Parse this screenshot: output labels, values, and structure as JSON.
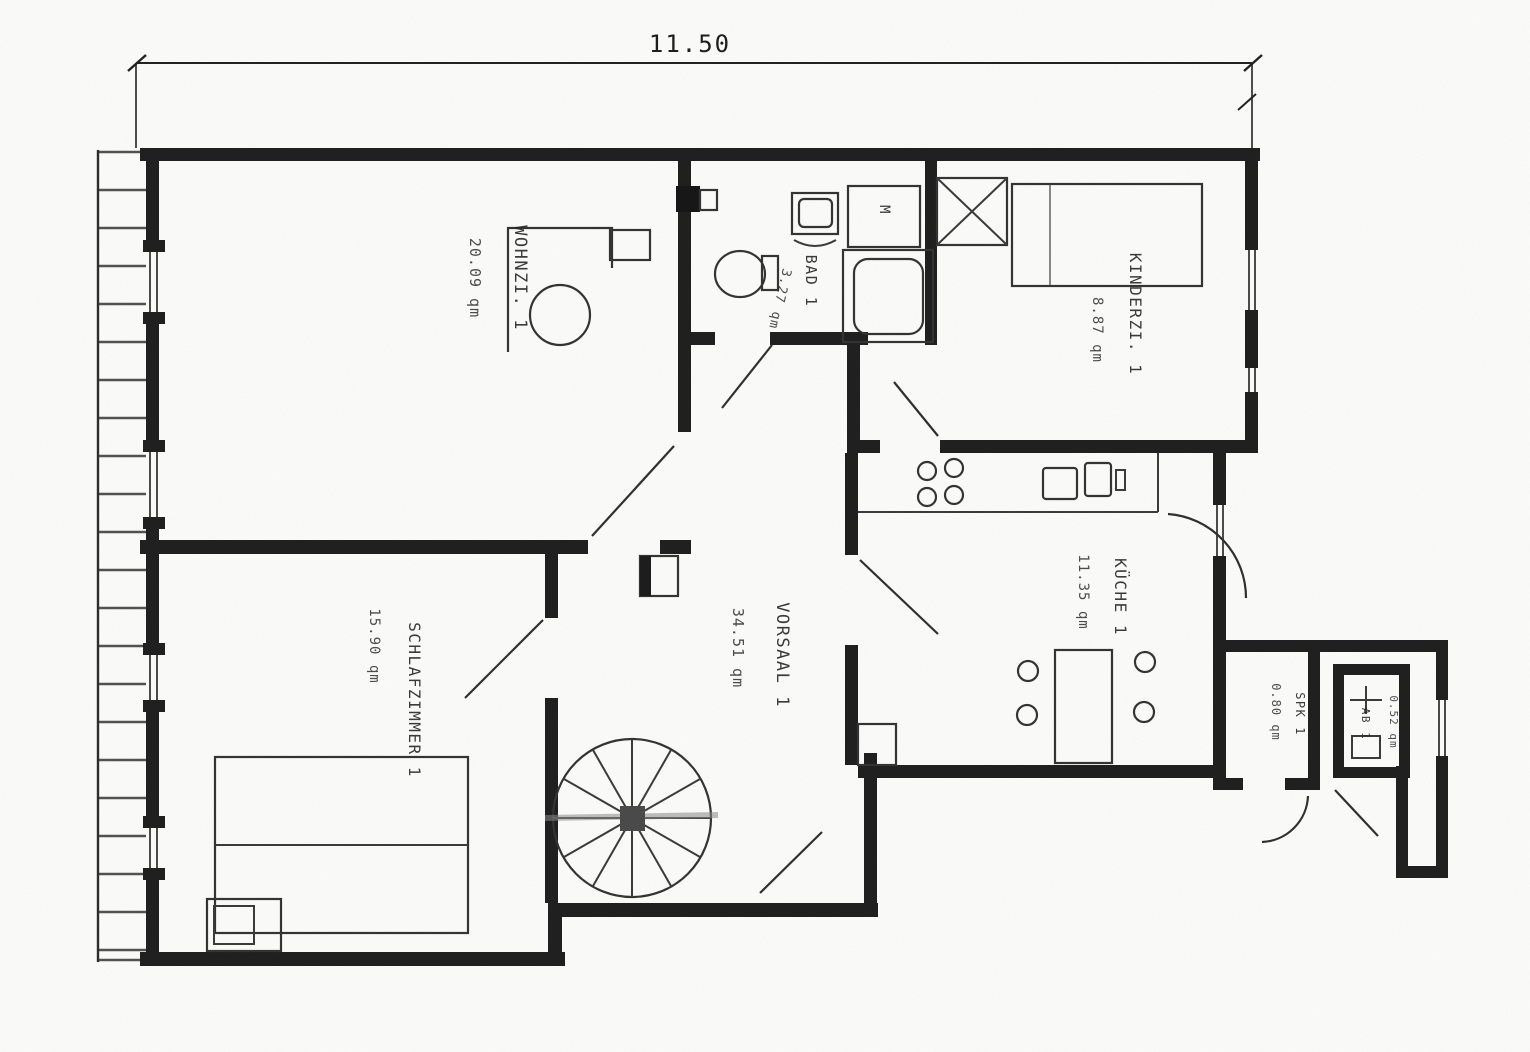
{
  "plan": {
    "dimension_top": "11.50",
    "unit": "qm"
  },
  "rooms": [
    {
      "id": "wohnzimmer",
      "name": "WOHNZI. 1",
      "area": "20.09 qm"
    },
    {
      "id": "bad",
      "name": "BAD 1",
      "area": "3.27 qm"
    },
    {
      "id": "kinderzimmer",
      "name": "KINDERZI. 1",
      "area": "8.87 qm"
    },
    {
      "id": "kueche",
      "name": "KÜCHE 1",
      "area": "11.35 qm"
    },
    {
      "id": "vorsaal",
      "name": "VORSAAL 1",
      "area": "34.51 qm"
    },
    {
      "id": "schlafzimmer",
      "name": "SCHLAFZIMMER 1",
      "area": "15.90 qm"
    },
    {
      "id": "spk",
      "name": "SPK 1",
      "area": "0.80 qm"
    },
    {
      "id": "ab",
      "name": "AB 1",
      "area": "0.52 qm"
    }
  ],
  "fixtures": {
    "washing_machine_label": "M"
  }
}
